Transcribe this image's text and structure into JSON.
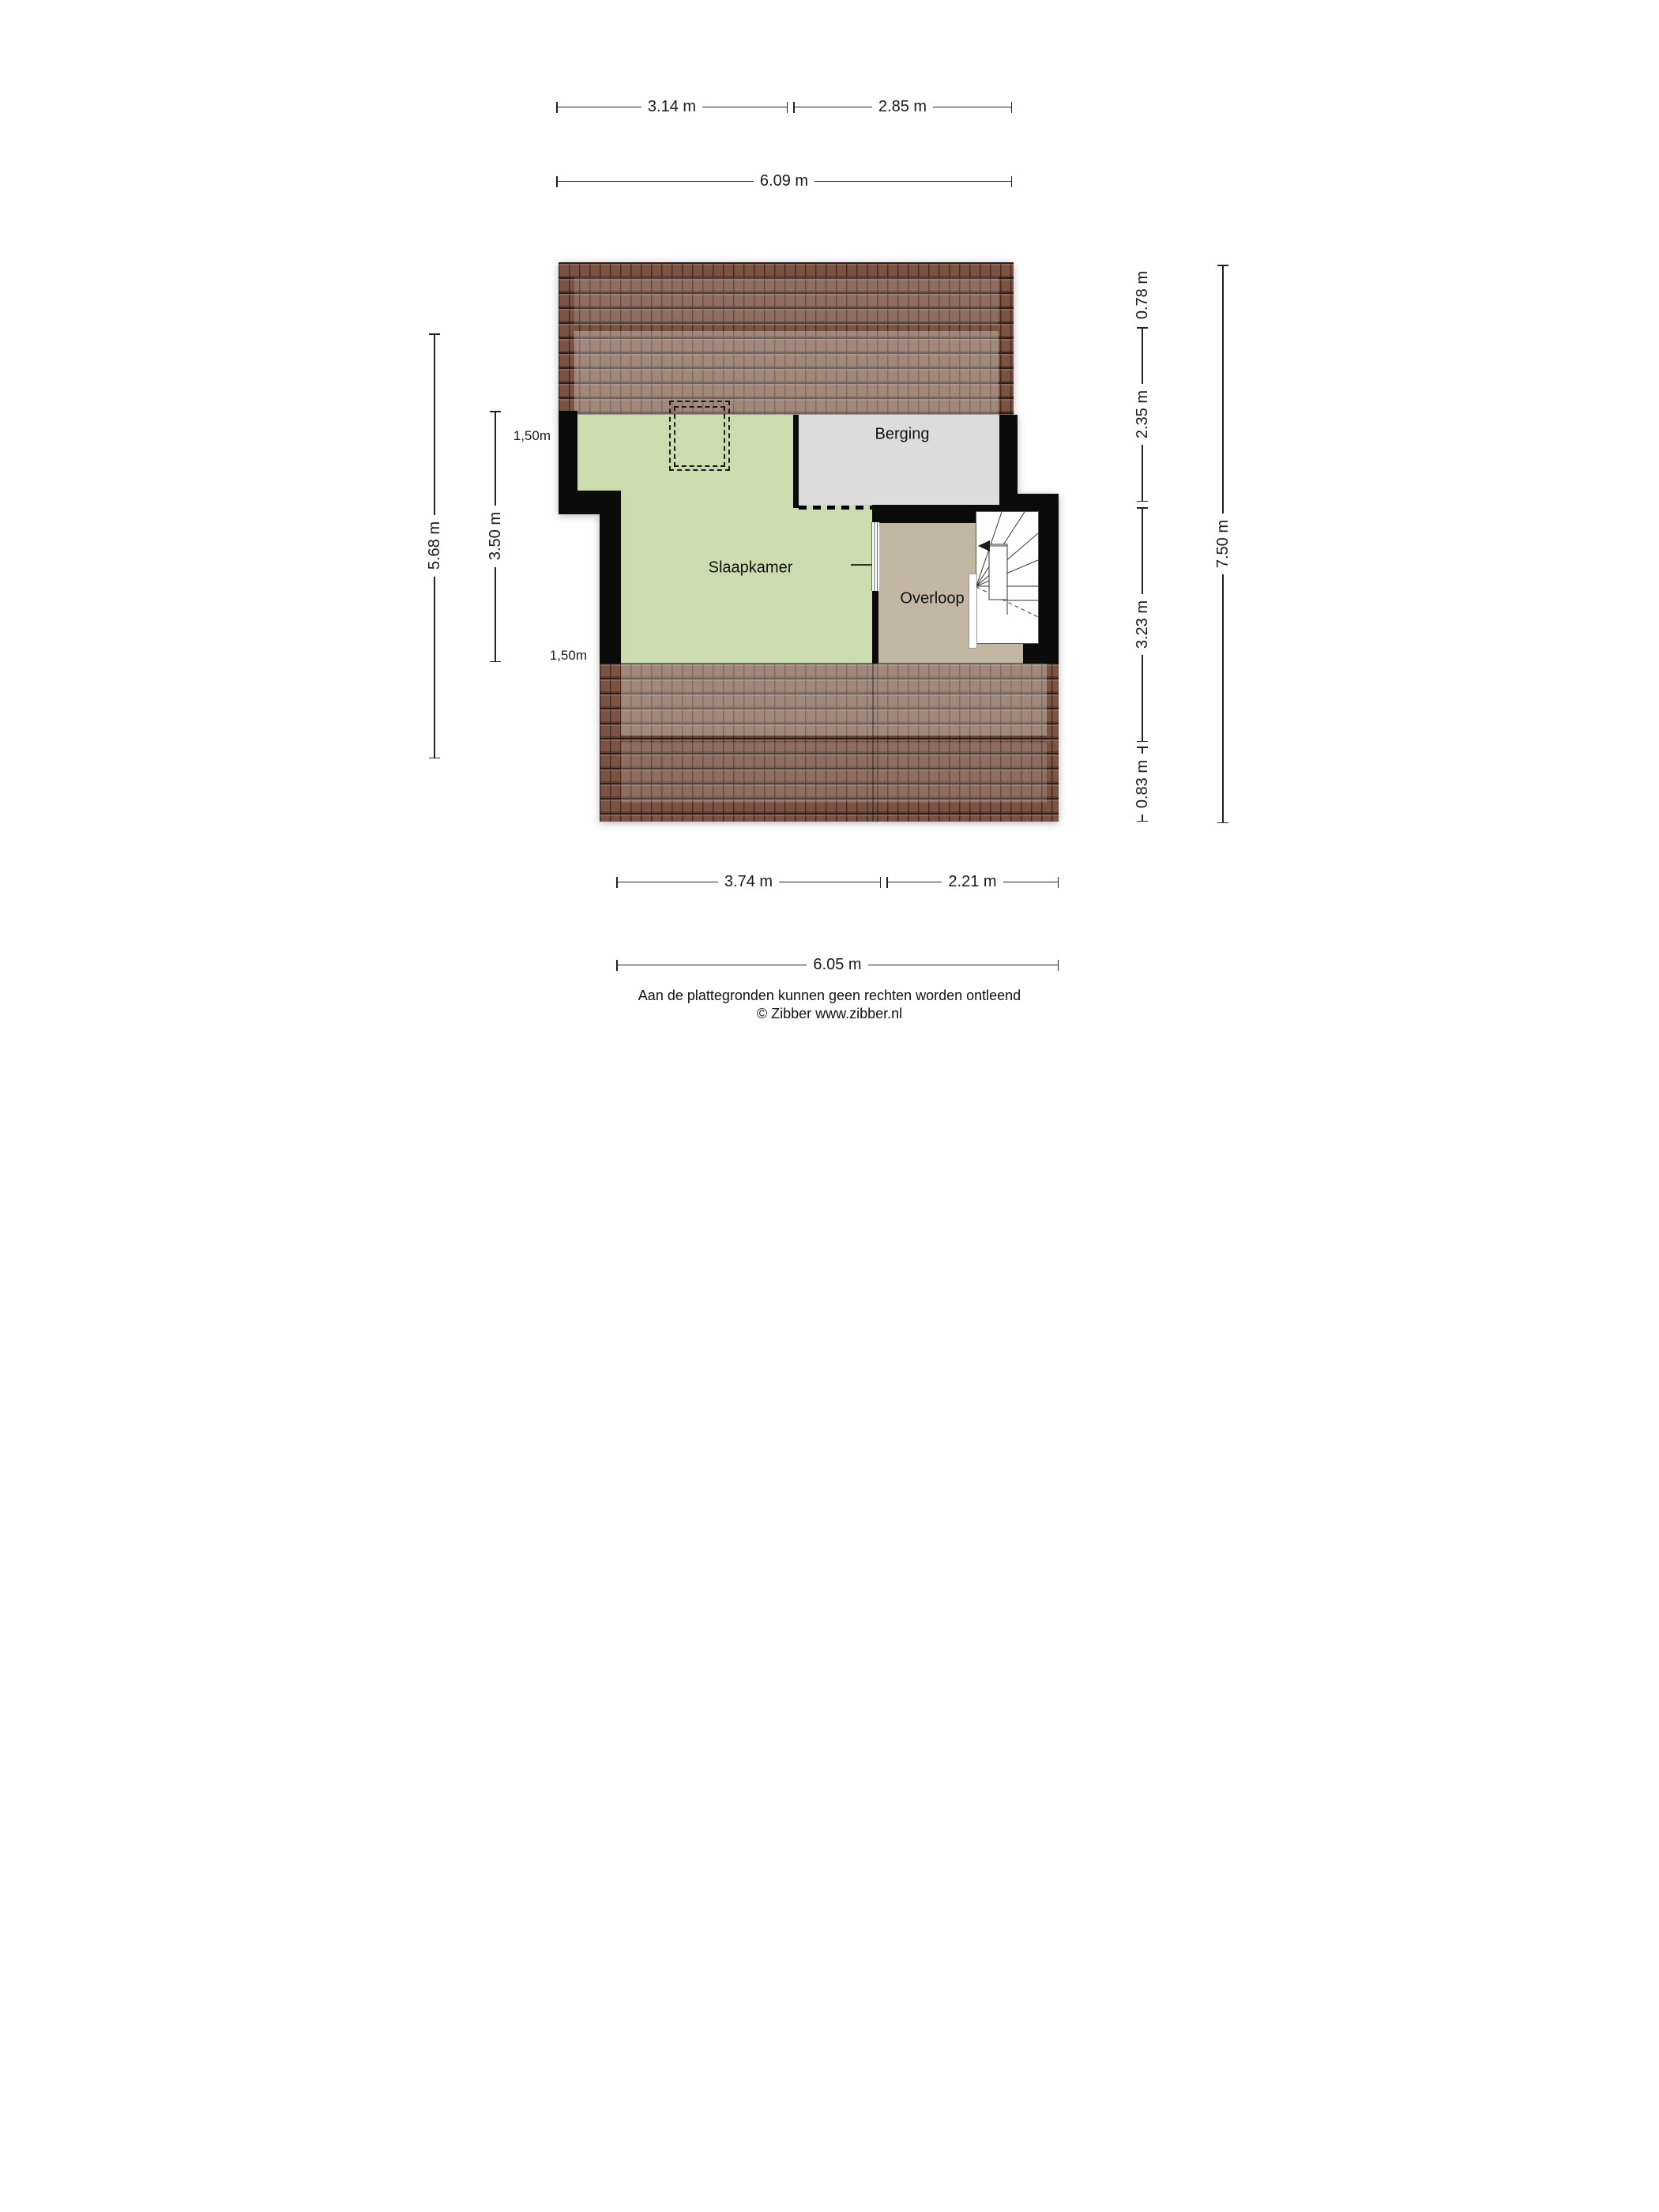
{
  "rooms": {
    "berging": "Berging",
    "slaapkamer": "Slaapkamer",
    "overloop": "Overloop"
  },
  "dims": {
    "top_left": "3.14 m",
    "top_right": "2.85 m",
    "top_total": "6.09 m",
    "left_outer": "5.68 m",
    "left_inner": "3.50 m",
    "right_seg1": "0.78 m",
    "right_seg2": "2.35 m",
    "right_seg3": "3.23 m",
    "right_seg4": "0.83 m",
    "right_total": "7.50 m",
    "bottom_left": "3.74 m",
    "bottom_right": "2.21 m",
    "bottom_total": "6.05 m"
  },
  "height_labels": {
    "top": "1,50m",
    "bottom": "1,50m"
  },
  "footer": {
    "disclaimer": "Aan de plattegronden kunnen geen rechten worden ontleend",
    "copyright": "© Zibber www.zibber.nl"
  },
  "colors": {
    "room-green": "#cbdcae",
    "room-gray": "#dcdcdc",
    "room-tan": "#c2b7a3",
    "roof-base": "#7a5343",
    "wall": "#0b0b0b",
    "dim": "#1a1a1a"
  }
}
